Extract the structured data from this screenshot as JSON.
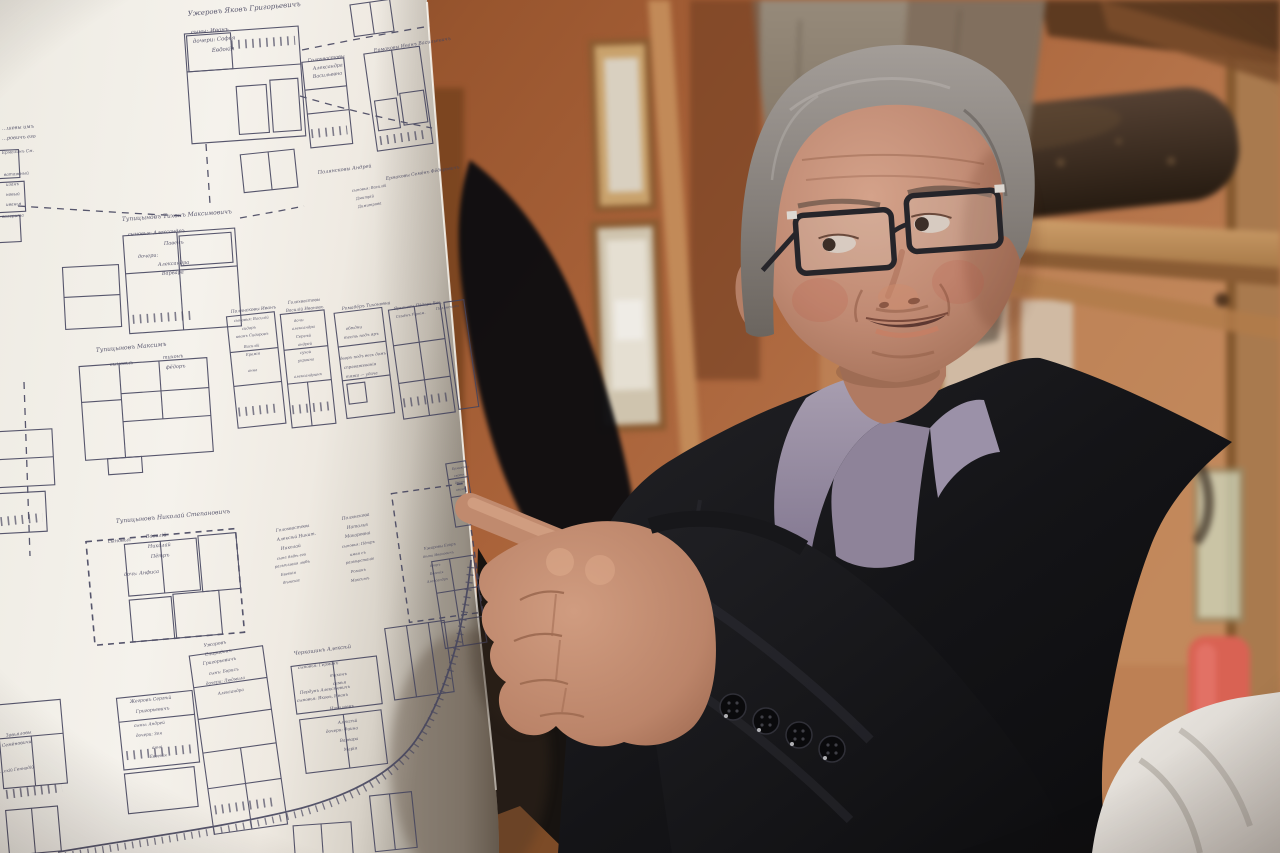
{
  "scene": {
    "kind": "photograph",
    "subject": "man in dark coat and glasses pointing at a large hand-drawn village plot map"
  },
  "colors": {
    "wall_terracotta": "#a65f38",
    "wood_light": "#c49263",
    "paper": "#f4f1ea",
    "map_ink": "#45445e",
    "hair_gray": "#8b8683",
    "skin": "#c18a74",
    "shirt_lavender": "#968ba3",
    "coat_charcoal": "#141417",
    "cloth_white": "#eae7e1",
    "red_object": "#d96253"
  },
  "map": {
    "labels": [
      {
        "t": "Ужеровъ Яковъ Григорьевичъ",
        "x": 188,
        "y": 16,
        "r": -5,
        "s": 7
      },
      {
        "t": "сыны: Иванъ",
        "x": 191,
        "y": 34,
        "r": -5,
        "s": 5.5
      },
      {
        "t": "дочери: Софья",
        "x": 193,
        "y": 43,
        "r": -5,
        "s": 5.5
      },
      {
        "t": "Евдокія",
        "x": 212,
        "y": 52,
        "r": -5,
        "s": 5.5
      },
      {
        "t": "Голохвастовы",
        "x": 308,
        "y": 62,
        "r": -7,
        "s": 4.8
      },
      {
        "t": "Александра",
        "x": 313,
        "y": 70,
        "r": -7,
        "s": 4.8
      },
      {
        "t": "Васильевна",
        "x": 313,
        "y": 78,
        "r": -7,
        "s": 4.8
      },
      {
        "t": "Ермаковы Иванъ Васильевичъ",
        "x": 374,
        "y": 52,
        "r": -9,
        "s": 4.8
      },
      {
        "t": "Полянсковы Андрей",
        "x": 318,
        "y": 174,
        "r": -7,
        "s": 5
      },
      {
        "t": "Ермаковы Семёнъ Фёдоровичъ",
        "x": 386,
        "y": 180,
        "r": -9,
        "s": 4.5
      },
      {
        "t": "сыновья: Василій",
        "x": 352,
        "y": 192,
        "r": -9,
        "s": 3.8
      },
      {
        "t": "Дмитрій",
        "x": 356,
        "y": 200,
        "r": -9,
        "s": 3.8
      },
      {
        "t": "Димитрова",
        "x": 358,
        "y": 208,
        "r": -9,
        "s": 3.8
      },
      {
        "t": "…шевы имъ",
        "x": 2,
        "y": 130,
        "r": -4,
        "s": 5
      },
      {
        "t": "…ровичъ его",
        "x": 2,
        "y": 140,
        "r": -4,
        "s": 5
      },
      {
        "t": "Ермолинъ См.",
        "x": 2,
        "y": 154,
        "r": -4,
        "s": 4.2
      },
      {
        "t": "ватажный",
        "x": 4,
        "y": 176,
        "r": -4,
        "s": 4.2
      },
      {
        "t": "изанъ",
        "x": 6,
        "y": 186,
        "r": -4,
        "s": 4.2
      },
      {
        "t": "новый",
        "x": 6,
        "y": 196,
        "r": -4,
        "s": 4.2
      },
      {
        "t": "иванья",
        "x": 6,
        "y": 206,
        "r": -4,
        "s": 4.2
      },
      {
        "t": "валерита",
        "x": 2,
        "y": 218,
        "r": -4,
        "s": 4.2
      },
      {
        "t": "Тупицыновъ Тихонъ Максимовичъ",
        "x": 122,
        "y": 221,
        "r": -4,
        "s": 6
      },
      {
        "t": "сыновья: Александръ",
        "x": 128,
        "y": 236,
        "r": -4,
        "s": 5
      },
      {
        "t": "Павелъ",
        "x": 164,
        "y": 245,
        "r": -4,
        "s": 5
      },
      {
        "t": "дочери:",
        "x": 138,
        "y": 258,
        "r": -4,
        "s": 5
      },
      {
        "t": "Александра",
        "x": 158,
        "y": 266,
        "r": -4,
        "s": 5
      },
      {
        "t": "Варвара",
        "x": 162,
        "y": 275,
        "r": -4,
        "s": 5
      },
      {
        "t": "Тупицыновъ Максимъ",
        "x": 96,
        "y": 352,
        "r": -5,
        "s": 6
      },
      {
        "t": "сыновья:",
        "x": 110,
        "y": 366,
        "r": -5,
        "s": 5
      },
      {
        "t": "тихонъ",
        "x": 163,
        "y": 359,
        "r": -5,
        "s": 5
      },
      {
        "t": "фёдоръ",
        "x": 166,
        "y": 369,
        "r": -5,
        "s": 5
      },
      {
        "t": "Полянсковы Иванъ",
        "x": 231,
        "y": 313,
        "r": -6,
        "s": 4.4
      },
      {
        "t": "сыновья: Василій",
        "x": 234,
        "y": 322,
        "r": -6,
        "s": 3.8
      },
      {
        "t": "сидоръ",
        "x": 242,
        "y": 330,
        "r": -6,
        "s": 3.8
      },
      {
        "t": "иванъ Сидоровъ",
        "x": 236,
        "y": 338,
        "r": -6,
        "s": 3.8
      },
      {
        "t": "Василій",
        "x": 244,
        "y": 348,
        "r": -6,
        "s": 3.8
      },
      {
        "t": "Еремія",
        "x": 246,
        "y": 356,
        "r": -6,
        "s": 3.8
      },
      {
        "t": "анна",
        "x": 248,
        "y": 372,
        "r": -6,
        "s": 3.8
      },
      {
        "t": "Голохвастовы",
        "x": 288,
        "y": 304,
        "r": -6,
        "s": 4.2
      },
      {
        "t": "Василій Ивановъ",
        "x": 286,
        "y": 312,
        "r": -6,
        "s": 4.2
      },
      {
        "t": "дочь:",
        "x": 294,
        "y": 322,
        "r": -6,
        "s": 3.8
      },
      {
        "t": "александра",
        "x": 292,
        "y": 330,
        "r": -6,
        "s": 3.8
      },
      {
        "t": "Сергѣй",
        "x": 296,
        "y": 338,
        "r": -6,
        "s": 3.8
      },
      {
        "t": "андрей",
        "x": 298,
        "y": 346,
        "r": -6,
        "s": 3.8
      },
      {
        "t": "сухой",
        "x": 300,
        "y": 354,
        "r": -6,
        "s": 3.8
      },
      {
        "t": "украина",
        "x": 298,
        "y": 362,
        "r": -6,
        "s": 3.8
      },
      {
        "t": "александринъ",
        "x": 294,
        "y": 378,
        "r": -6,
        "s": 3.8
      },
      {
        "t": "Ромадёръ Тихоновна",
        "x": 342,
        "y": 310,
        "r": -7,
        "s": 4.4
      },
      {
        "t": "обѣдни",
        "x": 346,
        "y": 330,
        "r": -7,
        "s": 4
      },
      {
        "t": "тесть подъ яръ",
        "x": 344,
        "y": 339,
        "r": -7,
        "s": 4
      },
      {
        "t": "дворъ подъ весь домъ",
        "x": 340,
        "y": 360,
        "r": -7,
        "s": 4
      },
      {
        "t": "справажеванія",
        "x": 344,
        "y": 369,
        "r": -7,
        "s": 4
      },
      {
        "t": "тяжа — удача",
        "x": 346,
        "y": 378,
        "r": -7,
        "s": 4
      },
      {
        "t": "Ярышевы Пёдоръ Вас.",
        "x": 394,
        "y": 310,
        "r": -8,
        "s": 4
      },
      {
        "t": "Семёнъ Угрюм.",
        "x": 396,
        "y": 318,
        "r": -8,
        "s": 3.6
      },
      {
        "t": "Полянсковы",
        "x": 436,
        "y": 310,
        "r": -8,
        "s": 3.6
      },
      {
        "t": "Тупицыновъ Николай Степановичъ",
        "x": 116,
        "y": 523,
        "r": -5,
        "s": 6
      },
      {
        "t": "сыновья:",
        "x": 108,
        "y": 543,
        "r": -5,
        "s": 5
      },
      {
        "t": "Василій",
        "x": 146,
        "y": 538,
        "r": -5,
        "s": 5
      },
      {
        "t": "Николай",
        "x": 148,
        "y": 548,
        "r": -5,
        "s": 5
      },
      {
        "t": "Пётръ",
        "x": 151,
        "y": 558,
        "r": -5,
        "s": 5
      },
      {
        "t": "дочь: Анфиса",
        "x": 124,
        "y": 576,
        "r": -5,
        "s": 5
      },
      {
        "t": "Голохвастовы",
        "x": 276,
        "y": 532,
        "r": -9,
        "s": 4.4
      },
      {
        "t": "Алексѣй Никит.",
        "x": 277,
        "y": 541,
        "r": -9,
        "s": 4.4
      },
      {
        "t": "Николай",
        "x": 281,
        "y": 550,
        "r": -9,
        "s": 4.4
      },
      {
        "t": "сыне дядѣ его",
        "x": 277,
        "y": 560,
        "r": -9,
        "s": 3.8
      },
      {
        "t": "разъѣзжая любъ",
        "x": 275,
        "y": 568,
        "r": -9,
        "s": 3.8
      },
      {
        "t": "Евгенія",
        "x": 281,
        "y": 576,
        "r": -9,
        "s": 3.8
      },
      {
        "t": "дѣтскіе",
        "x": 283,
        "y": 584,
        "r": -9,
        "s": 3.8
      },
      {
        "t": "Полянскова",
        "x": 342,
        "y": 520,
        "r": -9,
        "s": 4.4
      },
      {
        "t": "Наталья",
        "x": 347,
        "y": 529,
        "r": -9,
        "s": 4.4
      },
      {
        "t": "Макаровна",
        "x": 345,
        "y": 538,
        "r": -9,
        "s": 4.4
      },
      {
        "t": "сыновья: Пётръ",
        "x": 342,
        "y": 548,
        "r": -9,
        "s": 3.8
      },
      {
        "t": "имая съ",
        "x": 350,
        "y": 556,
        "r": -9,
        "s": 3.8
      },
      {
        "t": "развѣрстаніе",
        "x": 346,
        "y": 564,
        "r": -9,
        "s": 3.8
      },
      {
        "t": "Романъ",
        "x": 351,
        "y": 573,
        "r": -9,
        "s": 3.8
      },
      {
        "t": "Максимъ",
        "x": 351,
        "y": 582,
        "r": -9,
        "s": 3.8
      },
      {
        "t": "Ужаровы Егоръ",
        "x": 424,
        "y": 550,
        "r": -9,
        "s": 3.8
      },
      {
        "t": "дѣти Ивановичъ",
        "x": 423,
        "y": 558,
        "r": -9,
        "s": 3.4
      },
      {
        "t": "дворъ",
        "x": 430,
        "y": 567,
        "r": -9,
        "s": 3.4
      },
      {
        "t": "Евгенія",
        "x": 430,
        "y": 575,
        "r": -9,
        "s": 3.4
      },
      {
        "t": "Александръ",
        "x": 427,
        "y": 583,
        "r": -9,
        "s": 3.4
      },
      {
        "t": "Ермаковы",
        "x": 452,
        "y": 470,
        "r": -9,
        "s": 3.2
      },
      {
        "t": "скотн.",
        "x": 454,
        "y": 477,
        "r": -9,
        "s": 3.2
      },
      {
        "t": "дворъ",
        "x": 455,
        "y": 484,
        "r": -9,
        "s": 3.2
      },
      {
        "t": "иванъ",
        "x": 456,
        "y": 491,
        "r": -9,
        "s": 3.2
      },
      {
        "t": "Черкашинъ Алексѣй",
        "x": 294,
        "y": 655,
        "r": -7,
        "s": 5.2
      },
      {
        "t": "сыновья: Германъ",
        "x": 298,
        "y": 669,
        "r": -7,
        "s": 4.2
      },
      {
        "t": "тихонъ",
        "x": 330,
        "y": 677,
        "r": -7,
        "s": 4.2
      },
      {
        "t": "семья",
        "x": 333,
        "y": 685,
        "r": -7,
        "s": 4.2
      },
      {
        "t": "Пердунъ Алексѣевичъ",
        "x": 300,
        "y": 694,
        "r": -7,
        "s": 4.2
      },
      {
        "t": "сыновья: Яковъ, Иванъ",
        "x": 297,
        "y": 702,
        "r": -7,
        "s": 4.2
      },
      {
        "t": "Николаевъ",
        "x": 330,
        "y": 710,
        "r": -7,
        "s": 4.2
      },
      {
        "t": "Алексѣй",
        "x": 338,
        "y": 724,
        "r": -7,
        "s": 4.2
      },
      {
        "t": "дочери: Фаина",
        "x": 326,
        "y": 733,
        "r": -7,
        "s": 4.2
      },
      {
        "t": "Варвара",
        "x": 340,
        "y": 742,
        "r": -7,
        "s": 4.2
      },
      {
        "t": "Марія",
        "x": 344,
        "y": 751,
        "r": -7,
        "s": 4.2
      },
      {
        "t": "Жегровъ Сергѣй",
        "x": 130,
        "y": 703,
        "r": -6,
        "s": 4.6
      },
      {
        "t": "Григорьевичъ",
        "x": 136,
        "y": 713,
        "r": -6,
        "s": 4.6
      },
      {
        "t": "сыны: Андрей",
        "x": 134,
        "y": 727,
        "r": -6,
        "s": 4.2
      },
      {
        "t": "дочери: Зоя",
        "x": 136,
        "y": 737,
        "r": -6,
        "s": 4.2
      },
      {
        "t": "анна",
        "x": 152,
        "y": 749,
        "r": -6,
        "s": 4.2
      },
      {
        "t": "Евгенія",
        "x": 150,
        "y": 758,
        "r": -6,
        "s": 4.2
      },
      {
        "t": "Ужаровъ",
        "x": 204,
        "y": 647,
        "r": -9,
        "s": 4.6
      },
      {
        "t": "Спиридонъ",
        "x": 205,
        "y": 656,
        "r": -9,
        "s": 4.6
      },
      {
        "t": "Григорьевичъ",
        "x": 203,
        "y": 665,
        "r": -9,
        "s": 4.6
      },
      {
        "t": "сынъ: Борисъ",
        "x": 209,
        "y": 675,
        "r": -9,
        "s": 4.2
      },
      {
        "t": "дочери: Людмила",
        "x": 206,
        "y": 685,
        "r": -9,
        "s": 4.2
      },
      {
        "t": "Александра",
        "x": 218,
        "y": 695,
        "r": -9,
        "s": 4.2
      },
      {
        "t": "Завьяловы",
        "x": 6,
        "y": 737,
        "r": -8,
        "s": 4.6
      },
      {
        "t": "Семёновичи",
        "x": 2,
        "y": 747,
        "r": -8,
        "s": 4.6
      },
      {
        "t": "…скій Геннадій",
        "x": 0,
        "y": 773,
        "r": -8,
        "s": 4.2
      }
    ]
  }
}
